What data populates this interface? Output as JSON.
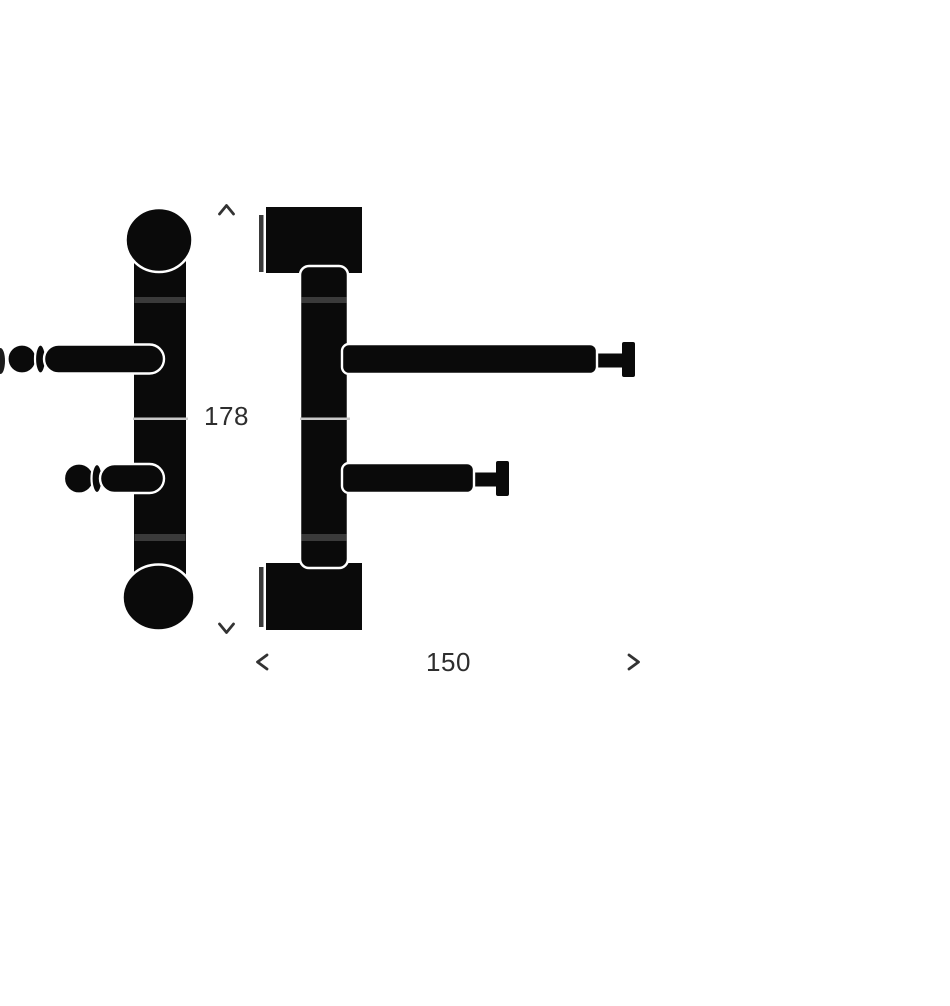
{
  "window": {
    "background": "#ffffff"
  },
  "diagram": {
    "type": "technical-drawing",
    "ink_color": "#0a0a0a",
    "label_color": "#2e2e2e",
    "detail_gray": "#3a3a3a",
    "seam_gray": "#c9c9c9",
    "dimensions": {
      "height": {
        "value": "178",
        "orientation": "vertical",
        "arrow_icons": [
          "arrow-up-icon",
          "arrow-down-icon"
        ]
      },
      "width": {
        "value": "150",
        "orientation": "horizontal",
        "arrow_icons": [
          "arrow-left-icon",
          "arrow-right-icon"
        ]
      }
    }
  }
}
